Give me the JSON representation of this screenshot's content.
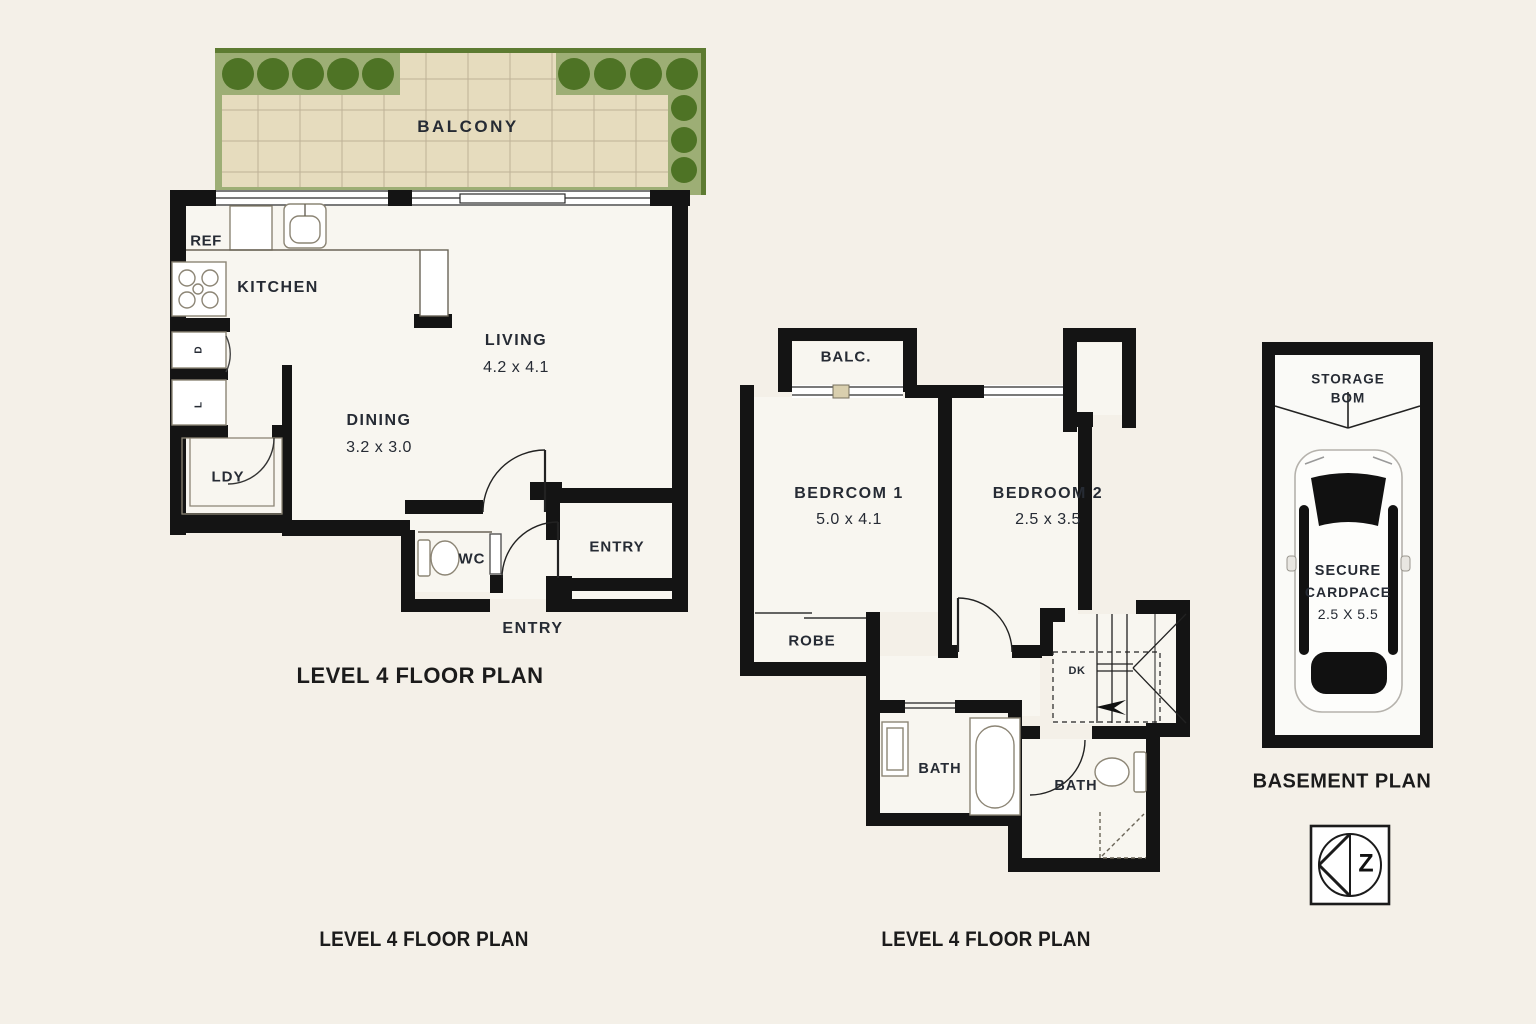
{
  "plan_left": {
    "balcony": "BALCONY",
    "kitchen": "KITCHEN",
    "ref": "REF",
    "living": {
      "name": "LIVING",
      "dims": "4.2 x 4.1"
    },
    "dining": {
      "name": "DINING",
      "dims": "3.2 x 3.0"
    },
    "laundry": "LDY",
    "wc": "WC",
    "entry_room": "ENTRY",
    "entry_label": "ENTRY",
    "cabinet_top": "D",
    "cabinet_bottom": "L",
    "title": "LEVEL 4 FLOOR PLAN",
    "caption": "LEVEL 4 FLOOR PLAN"
  },
  "plan_middle": {
    "balcony": "BALC.",
    "bedroom1": {
      "name": "BEDRCOM 1",
      "dims": "5.0 x 4.1"
    },
    "bedroom2": {
      "name": "BEDROOM 2",
      "dims": "2.5 x 3.5"
    },
    "robe": "ROBE",
    "stair_label": "DK",
    "bath_left": "BATH",
    "bath_right": "BATH",
    "caption": "LEVEL 4 FLOOR PLAN"
  },
  "plan_basement": {
    "title": "BASEMENT PLAN",
    "storage_line1": "STORAGE",
    "storage_line2": "BOM",
    "car_line1": "SECURE",
    "car_line2": "CARDPACE",
    "car_dims": "2.5 X 5.5"
  },
  "compass": {
    "letter": "Z"
  },
  "colors": {
    "background": "#f4f0e8",
    "floor": "#f8f6f0",
    "wall": "#141414",
    "balcony_tile": "#e6dcbe",
    "tile_grid": "#beb297",
    "hedge_band": "#9dae75",
    "bush": "#4e7325",
    "hedge_edge": "#5d7b31"
  }
}
